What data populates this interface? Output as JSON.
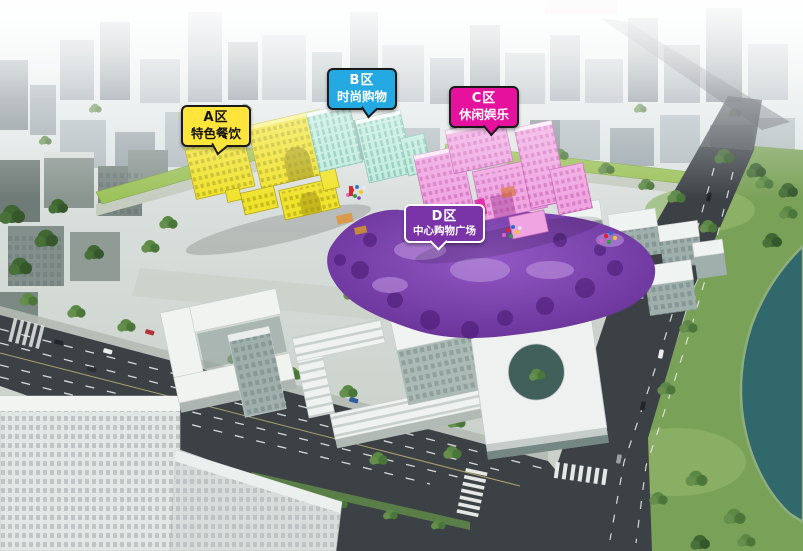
{
  "zones": [
    {
      "id": "A区",
      "name": "特色餐饮",
      "bubble_bg": "#FFE43C",
      "bubble_text": "#141414",
      "bubble_border": "#1A1A1A",
      "zone_color": "#F0E32C"
    },
    {
      "id": "B区",
      "name": "时尚购物",
      "bubble_bg": "#25A9E2",
      "bubble_text": "#FFFFFF",
      "bubble_border": "#1A1A1A",
      "zone_color": "#BCEBDC"
    },
    {
      "id": "C区",
      "name": "休闲娱乐",
      "bubble_bg": "#E6119C",
      "bubble_text": "#FFFFFF",
      "bubble_border": "#1A1A1A",
      "zone_color": "#F0A5E2"
    },
    {
      "id": "D区",
      "name": "中心购物广场",
      "bubble_bg": "#7B33A8",
      "bubble_text": "#FFFFFF",
      "bubble_border": "#FFFFFF",
      "zone_color": "#8348B4"
    }
  ],
  "palette": {
    "road": "#3C4146",
    "water": "#31686C",
    "greenery": "#6E9A52"
  }
}
